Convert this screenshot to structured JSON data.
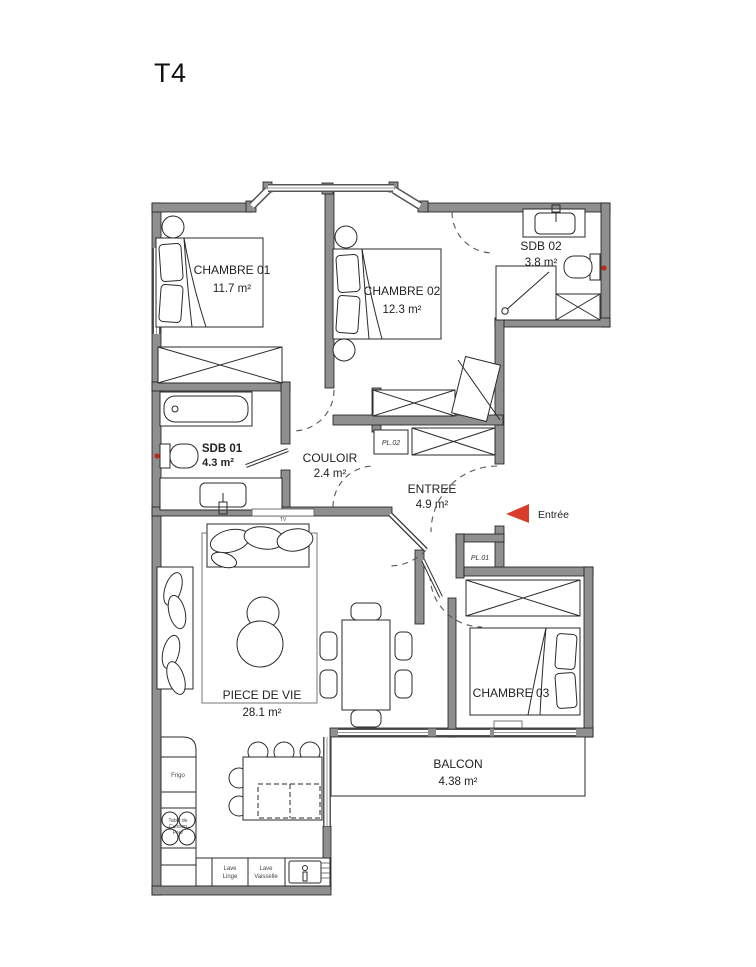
{
  "title": "T4",
  "accent_color": "#d93b2c",
  "rooms": {
    "chambre01": {
      "name": "CHAMBRE 01",
      "area": "11.7 m²"
    },
    "chambre02": {
      "name": "CHAMBRE 02",
      "area": "12.3 m²"
    },
    "chambre03": {
      "name": "CHAMBRE 03"
    },
    "sdb01": {
      "name": "SDB 01",
      "area": "4.3 m²"
    },
    "sdb02": {
      "name": "SDB 02",
      "area": "3.8 m²"
    },
    "couloir": {
      "name": "COULOIR",
      "area": "2.4 m²"
    },
    "entree": {
      "name": "ENTREE",
      "area": "4.9 m²"
    },
    "piece_de_vie": {
      "name": "PIECE DE VIE",
      "area": "28.1 m²"
    },
    "balcon": {
      "name": "BALCON",
      "area": "4.38 m²"
    }
  },
  "closets": {
    "pl01": "PL.01",
    "pl02": "PL.02"
  },
  "entry_marker": {
    "label": "Entrée"
  },
  "living": {
    "tv": "TV"
  },
  "kitchen": {
    "frigo": "Frigo",
    "cooktop": [
      "Table de",
      "Cuisson",
      "Four"
    ],
    "lave_linge": [
      "Lave",
      "Linge"
    ],
    "lave_vaisselle": [
      "Lave",
      "Vaisselle"
    ]
  }
}
